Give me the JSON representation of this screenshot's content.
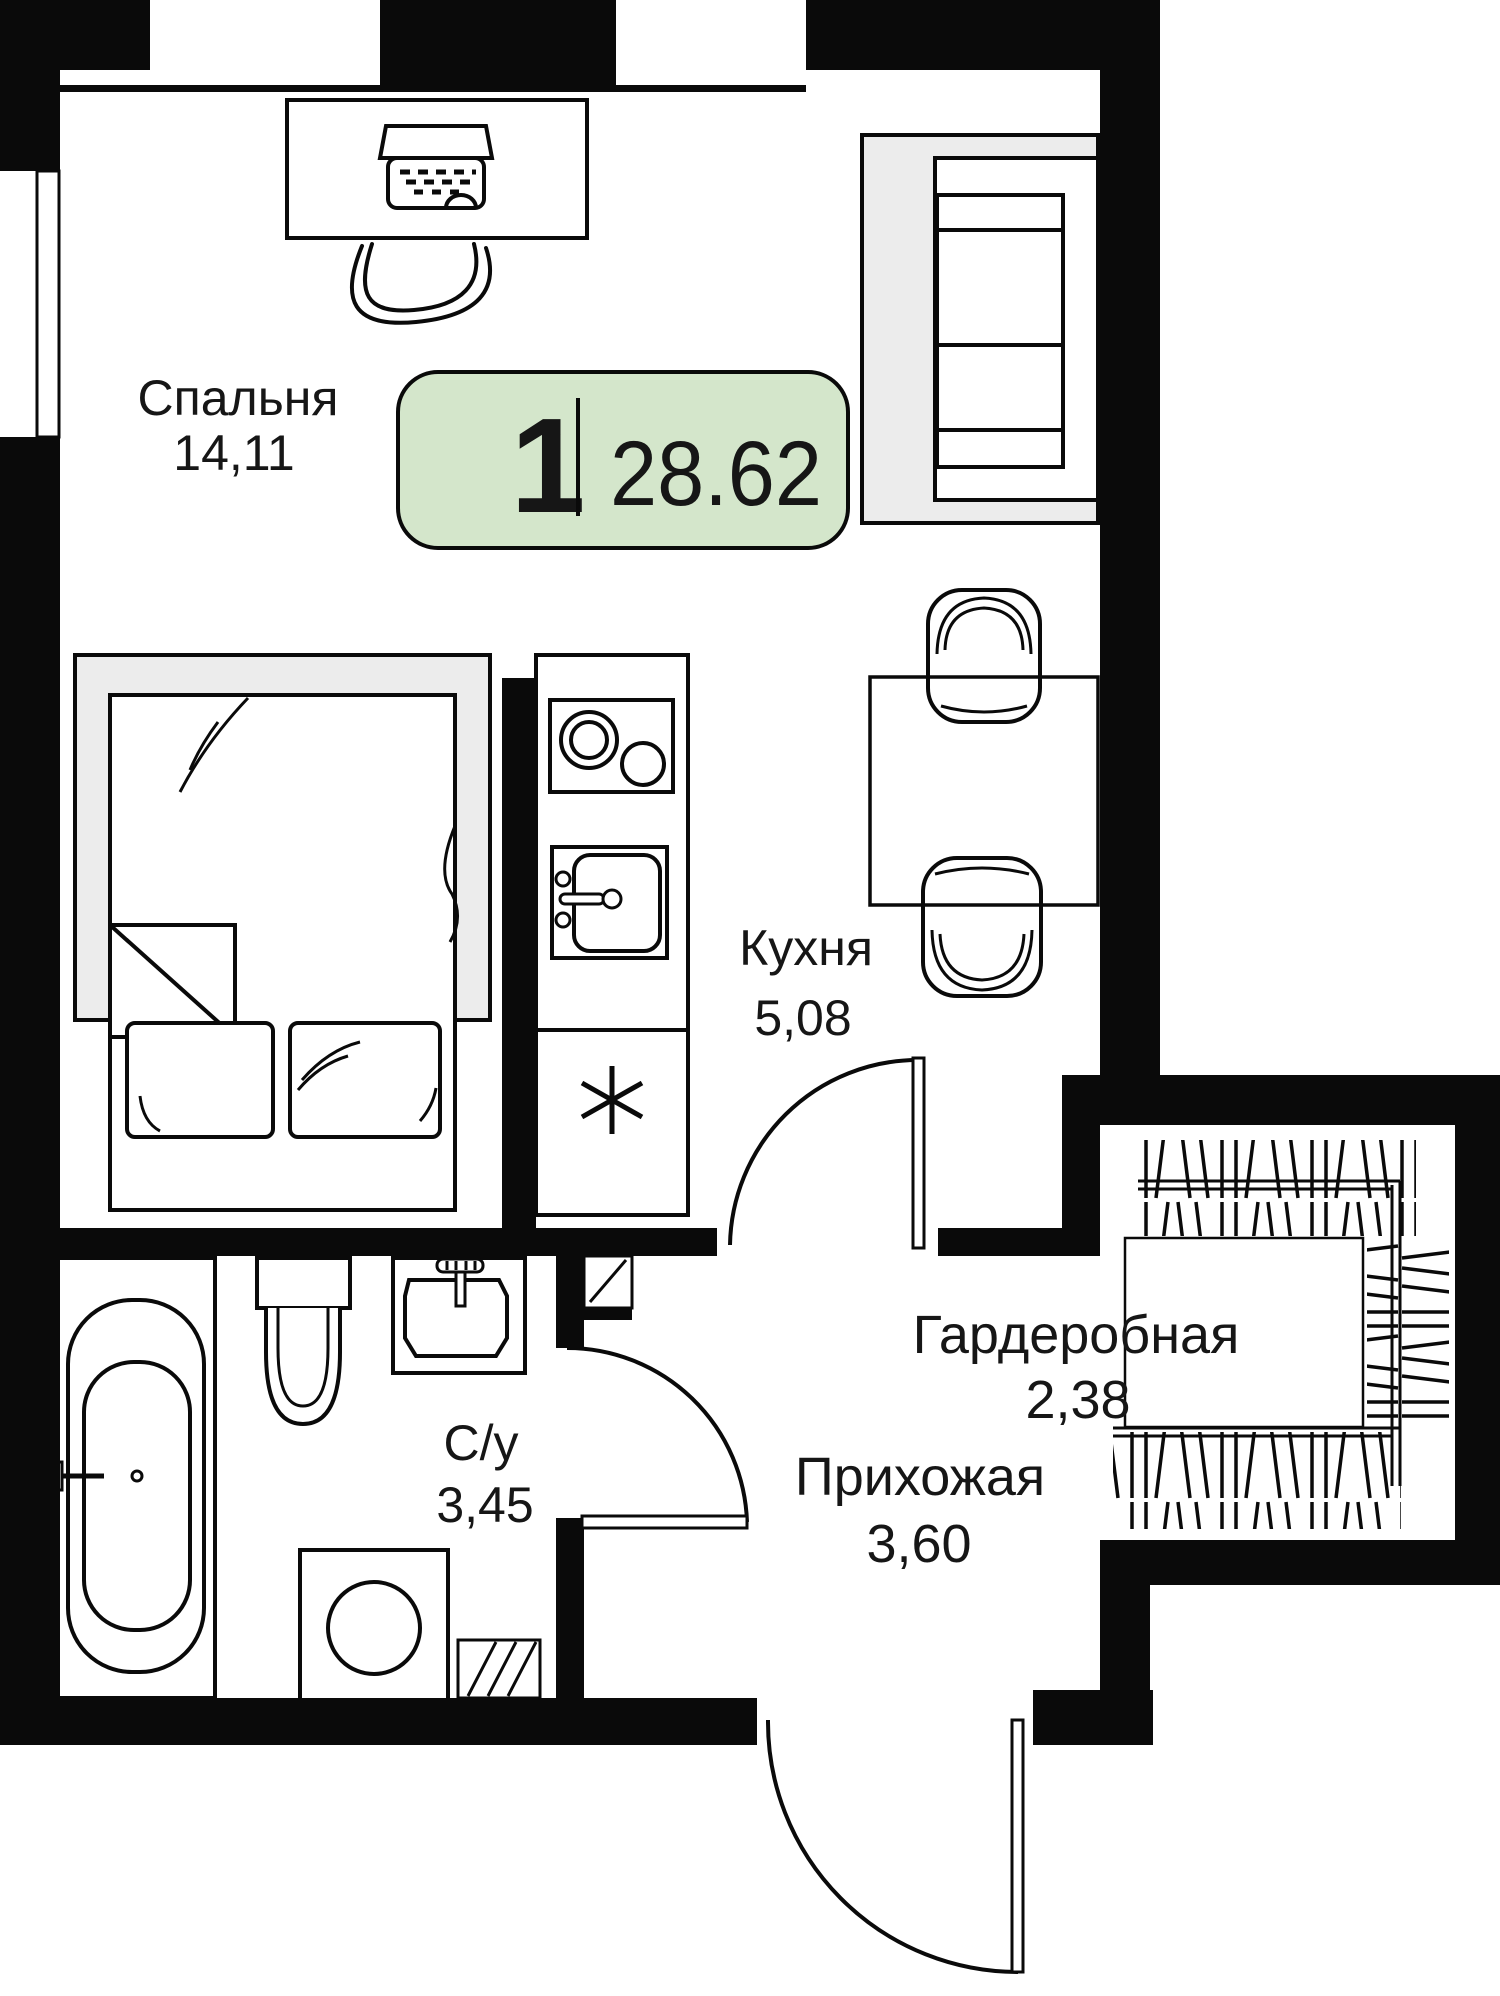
{
  "floorplan": {
    "badge": {
      "rooms_count": "1",
      "total_area": "28.62"
    },
    "rooms": [
      {
        "name": "Спальня",
        "area": "14,11"
      },
      {
        "name": "Кухня",
        "area": "5,08"
      },
      {
        "name": "С/у",
        "area": "3,45"
      },
      {
        "name": "Прихожая",
        "area": "3,60"
      },
      {
        "name": "Гардеробная",
        "area": "2,38"
      }
    ],
    "colors": {
      "badge_bg": "#d4e6cb",
      "wall": "#0a0a0a",
      "furniture_gray": "#ececec"
    }
  }
}
